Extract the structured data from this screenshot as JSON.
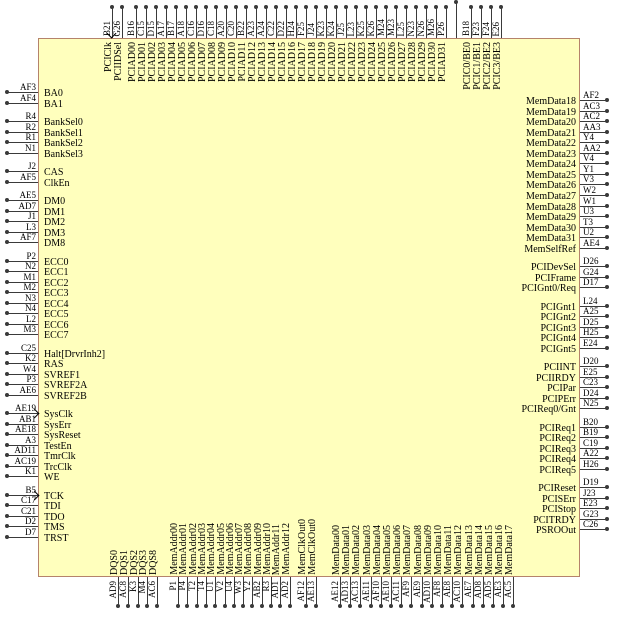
{
  "diagram": {
    "title": "chip-pinout",
    "colors": {
      "background": "#ffffff",
      "chip_fill": "#ffffbd",
      "chip_border": "#b5836b",
      "wire": "#3a3a3a",
      "text": "#000000"
    },
    "icons": {
      "clock_input": "chevron-arrow-icon"
    },
    "sides": {
      "top": {
        "groups": [
          {
            "pins": [
              {
                "code": "B21",
                "label": "PCIClk",
                "clock": true
              },
              {
                "code": "G26",
                "label": "PCIIDSel"
              }
            ]
          },
          {
            "pins": [
              {
                "code": "B16",
                "label": "PCIAD00"
              },
              {
                "code": "C15",
                "label": "PCIAD01"
              },
              {
                "code": "D15",
                "label": "PCIAD02"
              },
              {
                "code": "A17",
                "label": "PCIAD03"
              },
              {
                "code": "B17",
                "label": "PCIAD04"
              },
              {
                "code": "A18",
                "label": "PCIAD05"
              },
              {
                "code": "C16",
                "label": "PCIAD06"
              },
              {
                "code": "D16",
                "label": "PCIAD07"
              },
              {
                "code": "C18",
                "label": "PCIAD08"
              },
              {
                "code": "A20",
                "label": "PCIAD09"
              },
              {
                "code": "C20",
                "label": "PCIAD10"
              },
              {
                "code": "B22",
                "label": "PCIAD11"
              },
              {
                "code": "A23",
                "label": "PCIAD12"
              },
              {
                "code": "A24",
                "label": "PCIAD13"
              },
              {
                "code": "C22",
                "label": "PCIAD14"
              },
              {
                "code": "D22",
                "label": "PCIAD15"
              },
              {
                "code": "H24",
                "label": "PCIAD16"
              },
              {
                "code": "F25",
                "label": "PCIAD17"
              },
              {
                "code": "J24",
                "label": "PCIAD18"
              },
              {
                "code": "K23",
                "label": "PCIAD19"
              },
              {
                "code": "K24",
                "label": "PCIAD20"
              },
              {
                "code": "J25",
                "label": "PCIAD21"
              },
              {
                "code": "L23",
                "label": "PCIAD22"
              },
              {
                "code": "K25",
                "label": "PCIAD23"
              },
              {
                "code": "K26",
                "label": "PCIAD24"
              },
              {
                "code": "M24",
                "label": "PCIAD25"
              },
              {
                "code": "M23",
                "label": "PCIAD26"
              },
              {
                "code": "L25",
                "label": "PCIAD27"
              },
              {
                "code": "N23",
                "label": "PCIAD28"
              },
              {
                "code": "N26",
                "label": "PCIAD29"
              },
              {
                "code": "M26",
                "label": "PCIAD30"
              },
              {
                "code": "P26",
                "label": "PCIAD31"
              },
              {
                "code": "",
                "label": "",
                "tall": true
              }
            ]
          },
          {
            "pins": [
              {
                "code": "B18",
                "label": "PCIC0/BE0"
              },
              {
                "code": "F23",
                "label": "PCIC1/BE1"
              },
              {
                "code": "F24",
                "label": "PCIC2/BE2"
              },
              {
                "code": "E26",
                "label": "PCIC3/BE3"
              }
            ]
          }
        ]
      },
      "left": {
        "groups": [
          {
            "pins": [
              {
                "code": "AF3",
                "label": "BA0"
              },
              {
                "code": "AF4",
                "label": "BA1"
              }
            ]
          },
          {
            "pins": [
              {
                "code": "R4",
                "label": "BankSel0"
              },
              {
                "code": "R2",
                "label": "BankSel1"
              },
              {
                "code": "R1",
                "label": "BankSel2"
              },
              {
                "code": "N1",
                "label": "BankSel3"
              }
            ]
          },
          {
            "pins": [
              {
                "code": "J2",
                "label": "CAS"
              },
              {
                "code": "AF5",
                "label": "ClkEn"
              }
            ]
          },
          {
            "pins": [
              {
                "code": "AE5",
                "label": "DM0"
              },
              {
                "code": "AD7",
                "label": "DM1"
              },
              {
                "code": "J1",
                "label": "DM2"
              },
              {
                "code": "L3",
                "label": "DM3"
              },
              {
                "code": "AF7",
                "label": "DM8"
              }
            ]
          },
          {
            "pins": [
              {
                "code": "P2",
                "label": "ECC0"
              },
              {
                "code": "N2",
                "label": "ECC1"
              },
              {
                "code": "M1",
                "label": "ECC2"
              },
              {
                "code": "M2",
                "label": "ECC3"
              },
              {
                "code": "N3",
                "label": "ECC4"
              },
              {
                "code": "N4",
                "label": "ECC5"
              },
              {
                "code": "L2",
                "label": "ECC6"
              },
              {
                "code": "M3",
                "label": "ECC7"
              }
            ]
          },
          {
            "pins": [
              {
                "code": "C25",
                "label": "Halt[DrvrInh2]"
              },
              {
                "code": "K2",
                "label": "RAS"
              },
              {
                "code": "W4",
                "label": "SVREF1"
              },
              {
                "code": "P3",
                "label": "SVREF2A"
              },
              {
                "code": "AE6",
                "label": "SVREF2B"
              }
            ]
          },
          {
            "pins": [
              {
                "code": "AE19",
                "label": "SysClk",
                "clock": true
              },
              {
                "code": "AB1",
                "label": "SysErr"
              },
              {
                "code": "AE18",
                "label": "SysReset"
              },
              {
                "code": "A3",
                "label": "TestEn"
              },
              {
                "code": "AD11",
                "label": "TmrClk"
              },
              {
                "code": "AC19",
                "label": "TrcClk"
              },
              {
                "code": "K1",
                "label": "WE"
              }
            ]
          },
          {
            "pins": [
              {
                "code": "B5",
                "label": "TCK",
                "clock": true
              },
              {
                "code": "C17",
                "label": "TDI"
              },
              {
                "code": "C21",
                "label": "TDO"
              },
              {
                "code": "D2",
                "label": "TMS"
              },
              {
                "code": "D7",
                "label": "TRST"
              }
            ]
          }
        ]
      },
      "right": {
        "groups": [
          {
            "pins": [
              {
                "code": "AF2",
                "label": "MemData18"
              },
              {
                "code": "AC3",
                "label": "MemData19"
              },
              {
                "code": "AC2",
                "label": "MemData20"
              },
              {
                "code": "AA3",
                "label": "MemData21"
              },
              {
                "code": "Y4",
                "label": "MemData22"
              },
              {
                "code": "AA2",
                "label": "MemData23"
              },
              {
                "code": "V4",
                "label": "MemData24"
              },
              {
                "code": "Y1",
                "label": "MemData25"
              },
              {
                "code": "V3",
                "label": "MemData26"
              },
              {
                "code": "W2",
                "label": "MemData27"
              },
              {
                "code": "W1",
                "label": "MemData28"
              },
              {
                "code": "U3",
                "label": "MemData29"
              },
              {
                "code": "T3",
                "label": "MemData30"
              },
              {
                "code": "U2",
                "label": "MemData31"
              },
              {
                "code": "AE4",
                "label": "MemSelfRef"
              }
            ]
          },
          {
            "pins": [
              {
                "code": "D26",
                "label": "PCIDevSel"
              },
              {
                "code": "G24",
                "label": "PCIFrame"
              },
              {
                "code": "D17",
                "label": "PCIGnt0/Req"
              }
            ]
          },
          {
            "pins": [
              {
                "code": "L24",
                "label": "PCIGnt1"
              },
              {
                "code": "A25",
                "label": "PCIGnt2"
              },
              {
                "code": "D25",
                "label": "PCIGnt3"
              },
              {
                "code": "H25",
                "label": "PCIGnt4"
              },
              {
                "code": "E24",
                "label": "PCIGnt5"
              }
            ]
          },
          {
            "pins": [
              {
                "code": "D20",
                "label": "PCIINT"
              },
              {
                "code": "E25",
                "label": "PCIIRDY"
              },
              {
                "code": "C23",
                "label": "PCIPar"
              },
              {
                "code": "D24",
                "label": "PCIPErr"
              },
              {
                "code": "N25",
                "label": "PCIReq0/Gnt"
              }
            ]
          },
          {
            "pins": [
              {
                "code": "B20",
                "label": "PCIReq1"
              },
              {
                "code": "B19",
                "label": "PCIReq2"
              },
              {
                "code": "C19",
                "label": "PCIReq3"
              },
              {
                "code": "A22",
                "label": "PCIReq4"
              },
              {
                "code": "H26",
                "label": "PCIReq5"
              }
            ]
          },
          {
            "pins": [
              {
                "code": "D19",
                "label": "PCIReset"
              },
              {
                "code": "J23",
                "label": "PCISErr"
              },
              {
                "code": "E23",
                "label": "PCIStop"
              },
              {
                "code": "G23",
                "label": "PCITRDY"
              },
              {
                "code": "C26",
                "label": "PSROOut"
              }
            ]
          }
        ]
      },
      "bottom": {
        "groups": [
          {
            "pins": [
              {
                "code": "AD9",
                "label": "DQS0"
              },
              {
                "code": "AC8",
                "label": "DQS1"
              },
              {
                "code": "K3",
                "label": "DQS2"
              },
              {
                "code": "M4",
                "label": "DQS3"
              },
              {
                "code": "AC6",
                "label": "DQS8"
              }
            ]
          },
          {
            "pins": [
              {
                "code": "P1",
                "label": "MemAddr00"
              },
              {
                "code": "P4",
                "label": "MemAddr01"
              },
              {
                "code": "T2",
                "label": "MemAddr02"
              },
              {
                "code": "T4",
                "label": "MemAddr03"
              },
              {
                "code": "U1",
                "label": "MemAddr04"
              },
              {
                "code": "V2",
                "label": "MemAddr05"
              },
              {
                "code": "U4",
                "label": "MemAddr06"
              },
              {
                "code": "W3",
                "label": "MemAddr07"
              },
              {
                "code": "Y2",
                "label": "MemAddr08"
              },
              {
                "code": "AB2",
                "label": "MemAddr09"
              },
              {
                "code": "R3",
                "label": "MemAddr10"
              },
              {
                "code": "AD1",
                "label": "MemAddr11"
              },
              {
                "code": "AD2",
                "label": "MemAddr12"
              }
            ]
          },
          {
            "pins": [
              {
                "code": "AF12",
                "label": "MemClkOut0"
              },
              {
                "code": "AE13",
                "label": "MemClkOut0"
              }
            ]
          },
          {
            "pins": [
              {
                "code": "AE12",
                "label": "MemData00"
              },
              {
                "code": "AD13",
                "label": "MemData01"
              },
              {
                "code": "AC13",
                "label": "MemData02"
              },
              {
                "code": "AE11",
                "label": "MemData03"
              },
              {
                "code": "AF10",
                "label": "MemData04"
              },
              {
                "code": "AE10",
                "label": "MemData05"
              },
              {
                "code": "AC11",
                "label": "MemData06"
              },
              {
                "code": "AF9",
                "label": "MemData07"
              },
              {
                "code": "AE9",
                "label": "MemData08"
              },
              {
                "code": "AD10",
                "label": "MemData09"
              },
              {
                "code": "AF8",
                "label": "MemData10"
              },
              {
                "code": "AE8",
                "label": "MemData11"
              },
              {
                "code": "AC10",
                "label": "MemData12"
              },
              {
                "code": "AE7",
                "label": "MemData13"
              },
              {
                "code": "AD8",
                "label": "MemData14"
              },
              {
                "code": "AD5",
                "label": "MemData15"
              },
              {
                "code": "AE3",
                "label": "MemData16"
              },
              {
                "code": "AC5",
                "label": "MemData17"
              }
            ]
          }
        ]
      }
    }
  }
}
